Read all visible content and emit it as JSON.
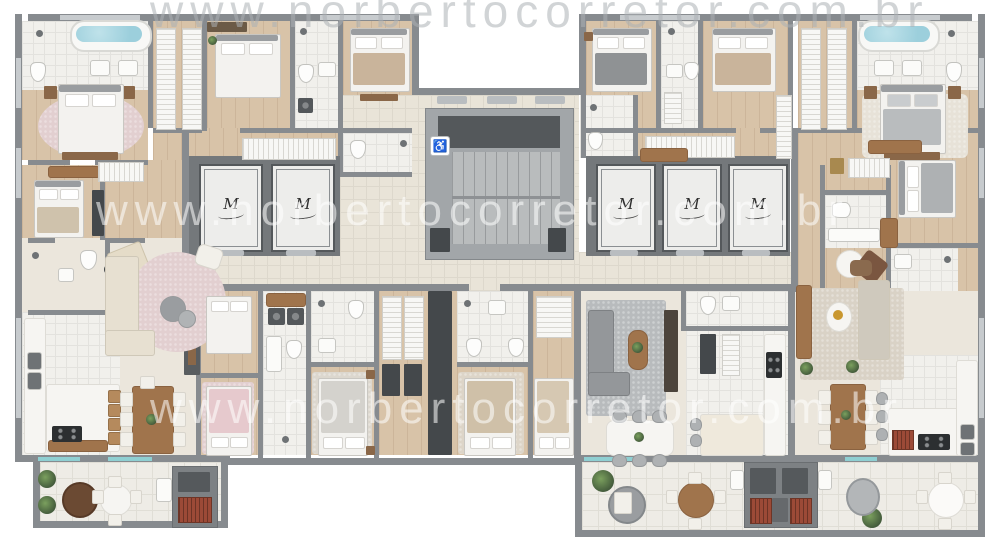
{
  "meta": {
    "type": "architectural-floor-plan",
    "view": "top-down color render"
  },
  "watermarks": {
    "top": "www.norbertocorretor.com.br",
    "middle_upper": "www.norbertocorretor.com.br",
    "middle_lower": "www.norbertocorretor.com.br"
  },
  "core": {
    "elevator_monogram": "M",
    "elevator_count": 5,
    "accessibility_symbol": "♿",
    "has_central_staircase": true
  },
  "inventory": {
    "master_suites_with_tub": 2,
    "bedrooms": 12,
    "terraces": 3,
    "barbecue_grills": 3,
    "dining_tables": 4,
    "kitchens": 3
  },
  "palette": {
    "wall": "#878b8f",
    "wallDark": "#5b5f62",
    "wood": "#d8c3a8",
    "tile": "#f1f0ec",
    "cream": "#ebe6dc",
    "hall": "#e9e4d8",
    "terrace": "#eeece6",
    "water": "#9ccfdc",
    "rugPink": "#e2cfd0",
    "rugGray": "#b8bbbd",
    "plant": "#4d6b44",
    "brick": "#9c4a37",
    "glass": "#8fcfd2",
    "marble": "#f6f5f2",
    "woodFurn": "#a0744c",
    "charcoal": "#44484b",
    "sofaBeige": "#e7e0d1"
  }
}
